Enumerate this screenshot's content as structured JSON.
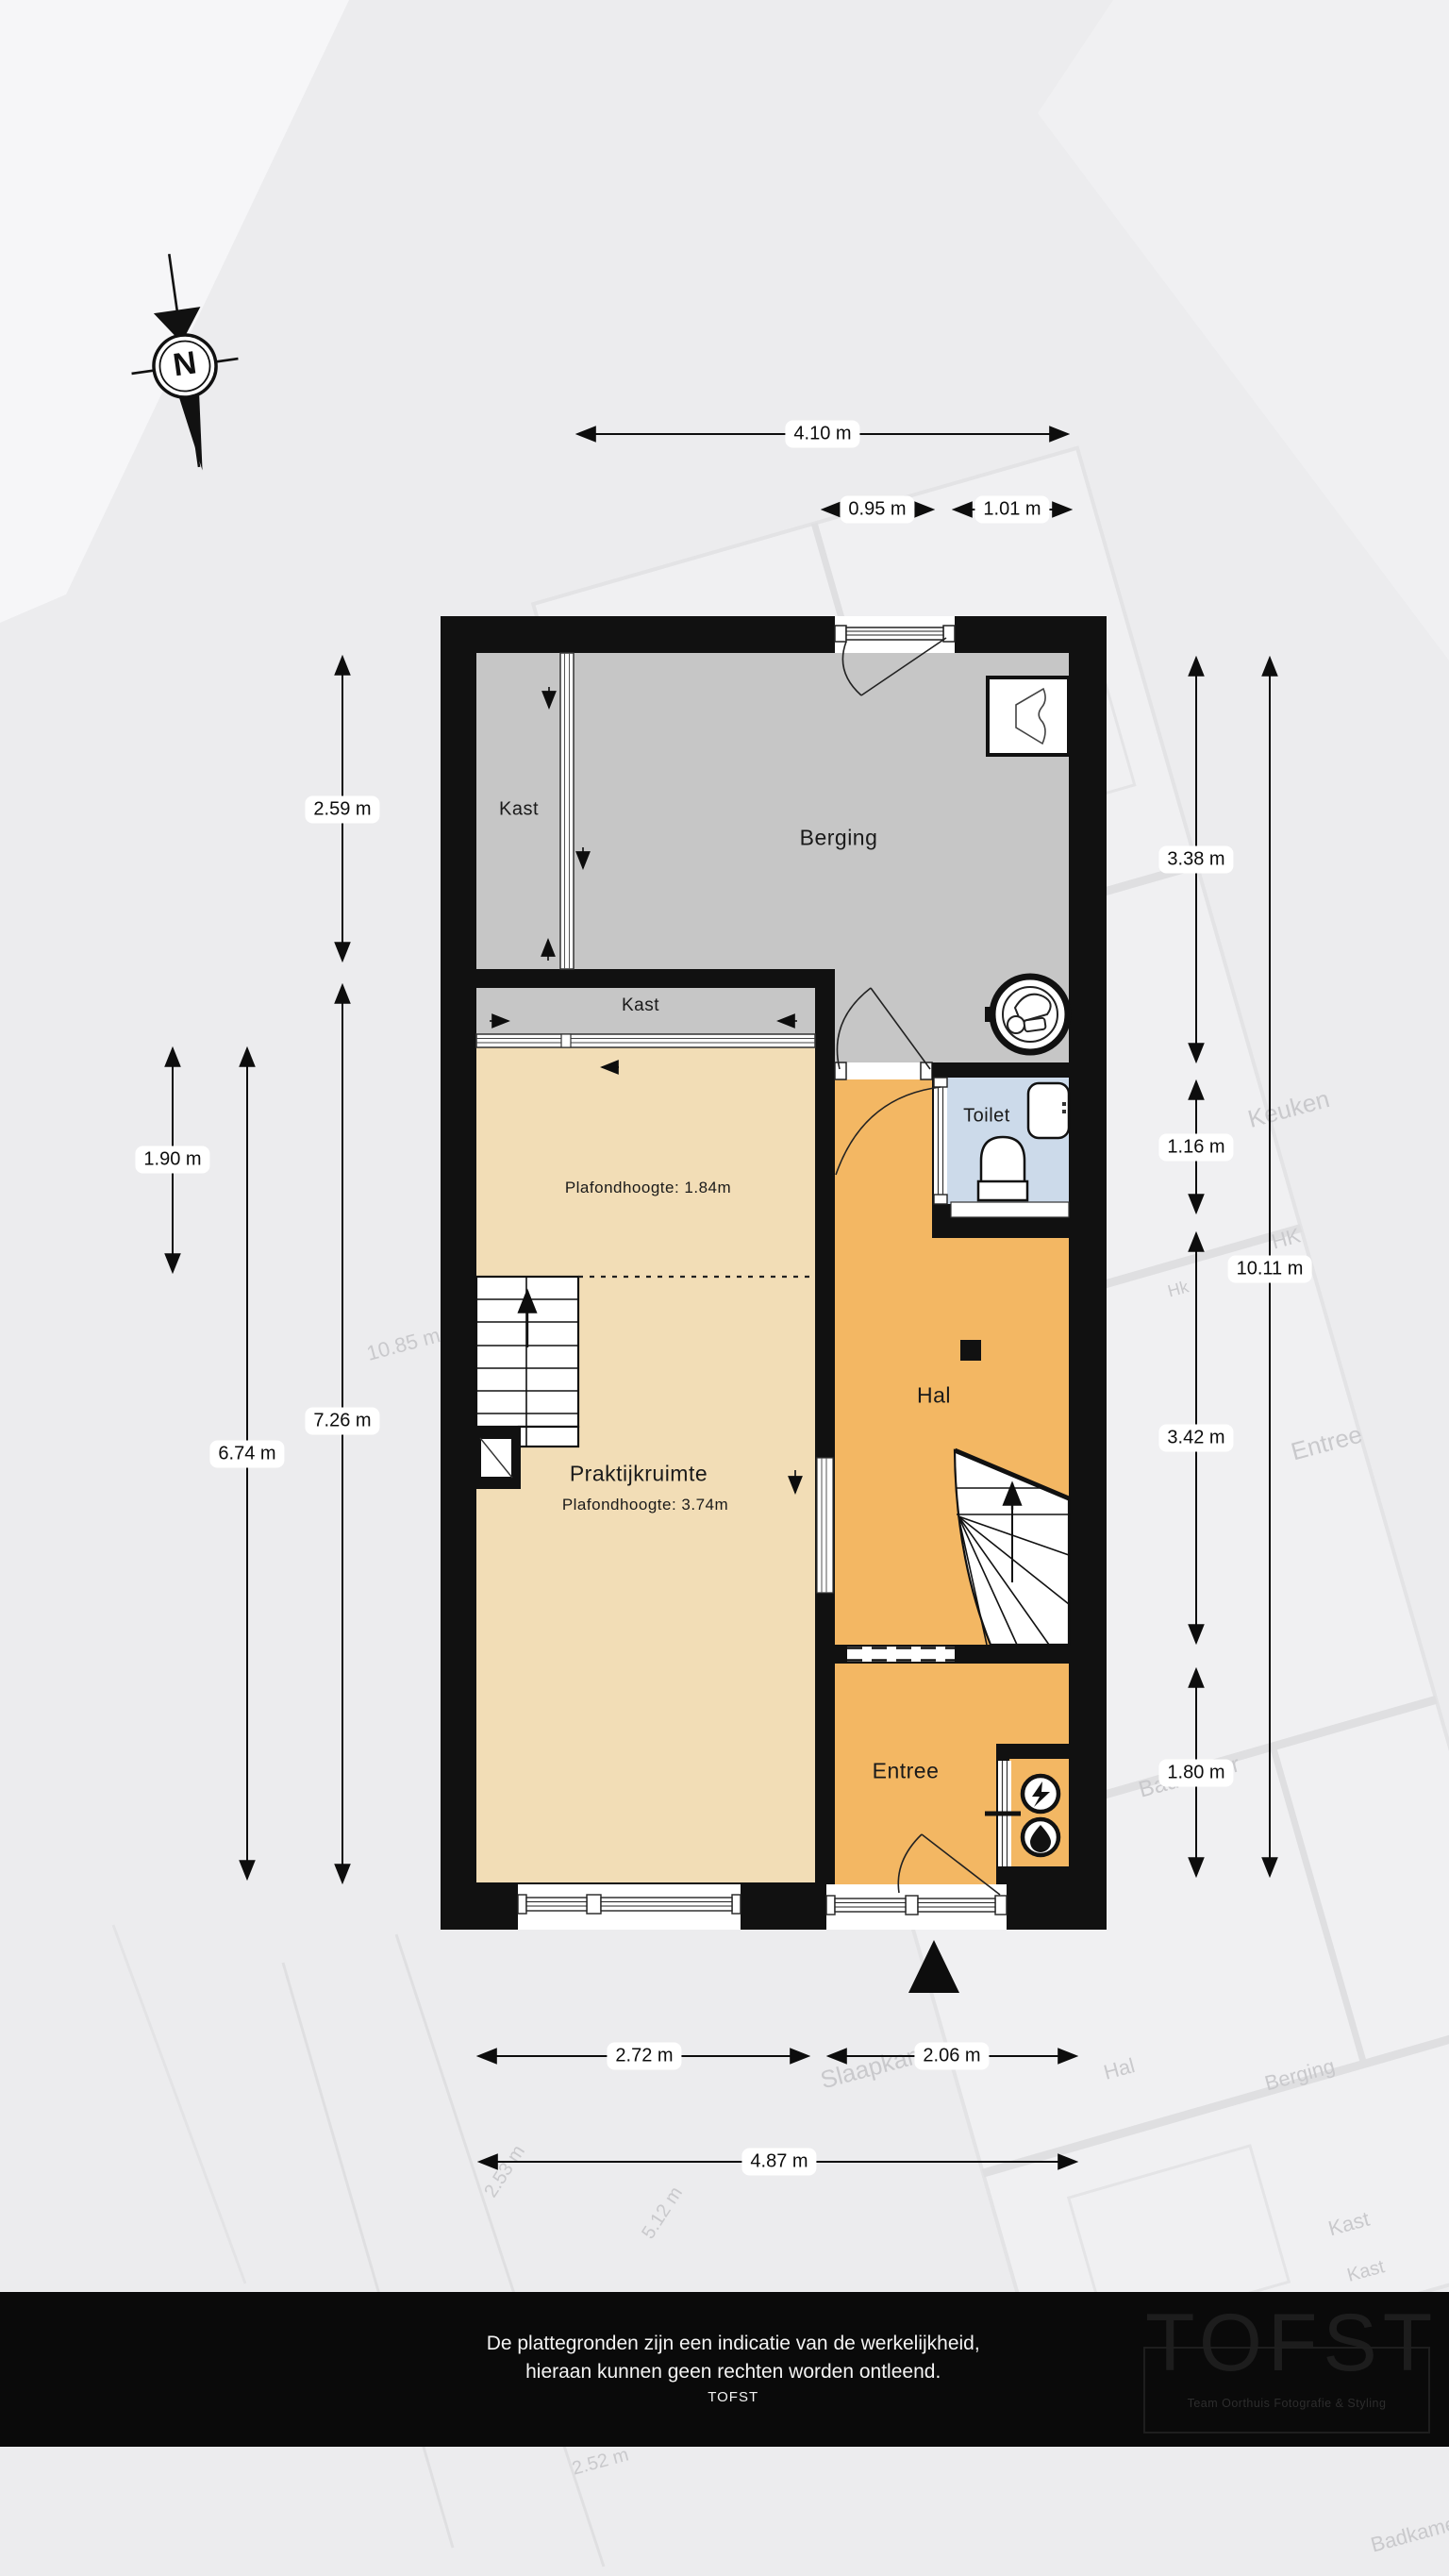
{
  "compass": {
    "label": "N"
  },
  "rooms": {
    "kast_top": "Kast",
    "berging": "Berging",
    "kast_mid": "Kast",
    "toilet": "Toilet",
    "hal": "Hal",
    "praktijkruimte": "Praktijkruimte",
    "praktijk_ceiling": "Plafondhoogte: 3.74m",
    "kast_ceiling": "Plafondhoogte: 1.84m",
    "entree": "Entree"
  },
  "dimensions": {
    "top_total": "4.10 m",
    "top_seg1": "0.95 m",
    "top_seg2": "1.01 m",
    "left_outer_top": "2.59 m",
    "left_outer_bottom": "7.26 m",
    "left_inner_top": "1.90 m",
    "left_inner_bottom": "6.74 m",
    "right_seg1": "3.38 m",
    "right_seg2": "1.16 m",
    "right_seg3": "3.42 m",
    "right_seg4": "1.80 m",
    "right_total": "10.11 m",
    "bottom_seg1": "2.72 m",
    "bottom_seg2": "2.06 m",
    "bottom_total": "4.87 m"
  },
  "footer": {
    "line1": "De plattegronden zijn een indicatie van de werkelijkheid,",
    "line2": "hieraan kunnen geen rechten worden ontleend.",
    "brand": "TOFST"
  },
  "logo": {
    "name": "TOFST",
    "tagline": "Team Oorthuis Fotografie & Styling"
  },
  "watermarks": {
    "keuken": "Keuken",
    "hk": "HK",
    "hk2": "Hk",
    "entree": "Entree",
    "m1085": "10.85 m",
    "badkamer": "Badkamer",
    "slaapkamer": "Slaapkamer",
    "hal": "Hal",
    "berging": "Berging",
    "kast": "Kast",
    "kast2": "Kast",
    "d253": "2.53 m",
    "d512": "5.12 m",
    "d252": "2.52 m",
    "badkamer2": "Badkamer"
  },
  "colors": {
    "wall": "#111111",
    "floor_gray": "#c6c6c6",
    "floor_tan": "#f2ddb6",
    "floor_orange": "#f3b763",
    "floor_toilet_blue": "#ccdaea",
    "footer_bg": "#0a0a0a",
    "dim_pill_bg": "#ffffff"
  }
}
